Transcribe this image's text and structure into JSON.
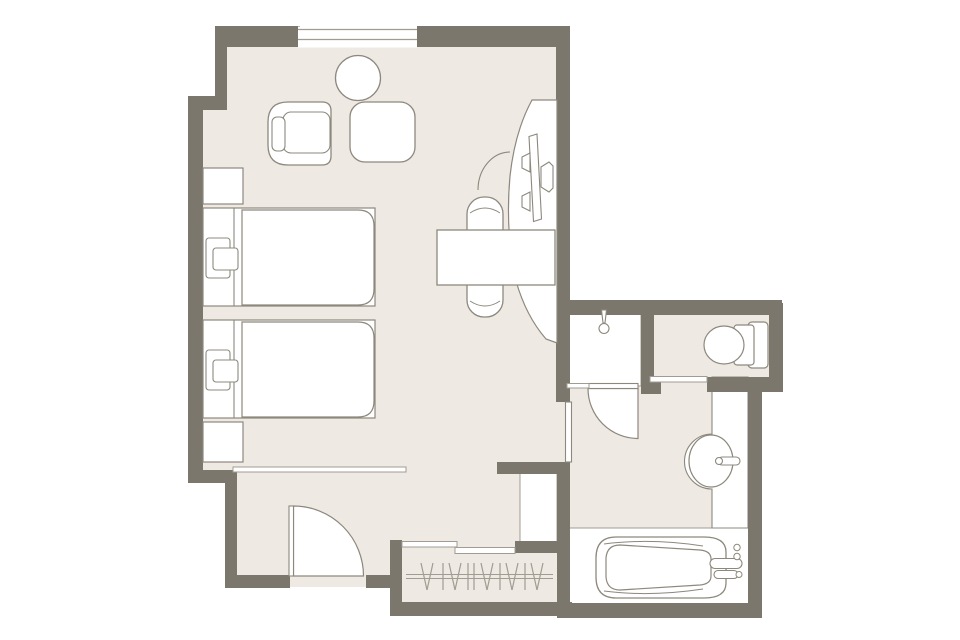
{
  "canvas": {
    "width": 960,
    "height": 640,
    "background": "#ffffff"
  },
  "palette": {
    "wall": "#7b776c",
    "floor": "#efe9e3",
    "white": "#ffffff",
    "stroke": "#8d887d",
    "thin": "#a19c91"
  },
  "plan": {
    "layer_order": [
      "floors",
      "white_areas",
      "walls",
      "window",
      "doors_markers",
      "fixtures",
      "furniture",
      "closet_lines"
    ],
    "floors": [
      {
        "n": "floor-upper-bedroom",
        "t": "rect",
        "x": 218,
        "y": 30,
        "w": 345,
        "h": 80,
        "f": "floor"
      },
      {
        "n": "floor-bedroom",
        "t": "rect",
        "x": 200,
        "y": 100,
        "w": 362,
        "h": 370,
        "f": "floor"
      },
      {
        "n": "floor-entry-corridor",
        "t": "rect",
        "x": 230,
        "y": 464,
        "w": 332,
        "h": 123,
        "f": "floor"
      },
      {
        "n": "floor-closet",
        "t": "rect",
        "x": 396,
        "y": 520,
        "w": 168,
        "h": 88,
        "f": "floor"
      },
      {
        "n": "floor-bathroom",
        "t": "rect",
        "x": 562,
        "y": 308,
        "w": 194,
        "h": 302,
        "f": "floor"
      },
      {
        "n": "floor-toilet-room",
        "t": "rect",
        "x": 648,
        "y": 308,
        "w": 128,
        "h": 77,
        "f": "floor"
      }
    ],
    "white_areas": [
      {
        "n": "shower-tray",
        "t": "rect",
        "x": 566,
        "y": 310,
        "w": 75,
        "h": 76,
        "f": "white",
        "s": "thin",
        "sw": 1
      },
      {
        "n": "bathtub-room-floor",
        "t": "rect",
        "x": 562,
        "y": 528,
        "w": 194,
        "h": 82,
        "f": "white",
        "s": "thin",
        "sw": 1
      },
      {
        "n": "service-void",
        "t": "rect",
        "x": 520,
        "y": 472,
        "w": 37,
        "h": 71,
        "f": "white",
        "s": "thin",
        "sw": 1
      },
      {
        "n": "vanity-counter",
        "t": "path",
        "d": "M712,377 L712,434 A27.5,27.5 0 0 0 712,489 L712,528 L748,528 L748,377 Z",
        "f": "white",
        "s": "stroke",
        "sw": 1.1
      }
    ],
    "walls": [
      {
        "n": "wall-top-left",
        "t": "rect",
        "x": 215,
        "y": 26,
        "w": 85,
        "h": 21,
        "f": "wall"
      },
      {
        "n": "wall-top-right",
        "t": "rect",
        "x": 417,
        "y": 26,
        "w": 153,
        "h": 21,
        "f": "wall"
      },
      {
        "n": "wall-upper-left",
        "t": "rect",
        "x": 215,
        "y": 26,
        "w": 12,
        "h": 76,
        "f": "wall"
      },
      {
        "n": "wall-left-step",
        "t": "rect",
        "x": 188,
        "y": 96,
        "w": 39,
        "h": 14,
        "f": "wall"
      },
      {
        "n": "wall-left",
        "t": "rect",
        "x": 188,
        "y": 96,
        "w": 15,
        "h": 387,
        "f": "wall"
      },
      {
        "n": "wall-entry-step",
        "t": "rect",
        "x": 188,
        "y": 470,
        "w": 49,
        "h": 13,
        "f": "wall"
      },
      {
        "n": "wall-entry-left",
        "t": "rect",
        "x": 225,
        "y": 470,
        "w": 12,
        "h": 118,
        "f": "wall"
      },
      {
        "n": "wall-entry-bottom-a",
        "t": "rect",
        "x": 225,
        "y": 575,
        "w": 65,
        "h": 13,
        "f": "wall"
      },
      {
        "n": "wall-entry-bottom-b",
        "t": "rect",
        "x": 366,
        "y": 575,
        "w": 36,
        "h": 13,
        "f": "wall"
      },
      {
        "n": "wall-closet-left",
        "t": "rect",
        "x": 390,
        "y": 540,
        "w": 12,
        "h": 76,
        "f": "wall"
      },
      {
        "n": "wall-closet-bottom",
        "t": "rect",
        "x": 390,
        "y": 602,
        "w": 182,
        "h": 14,
        "f": "wall"
      },
      {
        "n": "wall-closet-top",
        "t": "rect",
        "x": 515,
        "y": 541,
        "w": 55,
        "h": 12,
        "f": "wall"
      },
      {
        "n": "wall-closet-bath-divider",
        "t": "rect",
        "x": 557,
        "y": 462,
        "w": 13,
        "h": 156,
        "f": "wall"
      },
      {
        "n": "wall-bedroom-south-stub",
        "t": "rect",
        "x": 497,
        "y": 462,
        "w": 73,
        "h": 12,
        "f": "wall"
      },
      {
        "n": "wall-bedroom-right",
        "t": "rect",
        "x": 556,
        "y": 26,
        "w": 14,
        "h": 376,
        "f": "wall"
      },
      {
        "n": "wall-bathroom-top",
        "t": "rect",
        "x": 556,
        "y": 300,
        "w": 226,
        "h": 15,
        "f": "wall"
      },
      {
        "n": "wall-shower-right",
        "t": "rect",
        "x": 641,
        "y": 300,
        "w": 13,
        "h": 90,
        "f": "wall"
      },
      {
        "n": "wall-shower-corner-stub",
        "t": "rect",
        "x": 641,
        "y": 382,
        "w": 20,
        "h": 12,
        "f": "wall"
      },
      {
        "n": "wall-toilet-right",
        "t": "rect",
        "x": 769,
        "y": 303,
        "w": 14,
        "h": 89,
        "f": "wall"
      },
      {
        "n": "wall-toilet-bottom",
        "t": "rect",
        "x": 707,
        "y": 377,
        "w": 76,
        "h": 15,
        "f": "wall"
      },
      {
        "n": "wall-bathroom-right",
        "t": "rect",
        "x": 748,
        "y": 377,
        "w": 14,
        "h": 241,
        "f": "wall"
      },
      {
        "n": "wall-bathroom-bottom",
        "t": "rect",
        "x": 557,
        "y": 603,
        "w": 205,
        "h": 15,
        "f": "wall"
      }
    ],
    "window": [
      {
        "n": "window-opening",
        "t": "rect",
        "x": 298,
        "y": 26.5,
        "w": 119,
        "h": 21,
        "f": "white"
      },
      {
        "n": "window-frame-line-1",
        "t": "line",
        "x1": 298,
        "y1": 29.5,
        "x2": 417,
        "y2": 29.5,
        "s": "thin",
        "sw": 1.2
      },
      {
        "n": "window-frame-line-2",
        "t": "line",
        "x1": 298,
        "y1": 39.5,
        "x2": 417,
        "y2": 39.5,
        "s": "thin",
        "sw": 1.2
      }
    ],
    "doors_markers": [
      {
        "n": "entry-door-swing",
        "t": "path",
        "d": "M293.5,506 A70,70 0 0 1 363.5,576 L293.5,576 Z",
        "f": "white",
        "s": "stroke",
        "sw": 1.2
      },
      {
        "n": "entry-door-leaf",
        "t": "rect",
        "x": 289,
        "y": 506,
        "w": 4.5,
        "h": 70,
        "f": "white",
        "s": "stroke",
        "sw": 1.1
      },
      {
        "n": "bathroom-door-swing",
        "t": "path",
        "d": "M588,388.5 A50,50 0 0 0 638,438.5 L638,388.5 Z",
        "f": "white",
        "s": "stroke",
        "sw": 1.2
      },
      {
        "n": "bathroom-door-leaf",
        "t": "rect",
        "x": 588,
        "y": 383.5,
        "w": 50,
        "h": 5,
        "f": "white",
        "s": "stroke",
        "sw": 1.1
      },
      {
        "n": "bathroom-entry-panel",
        "t": "rect",
        "x": 565.5,
        "y": 402,
        "w": 6,
        "h": 60,
        "f": "white",
        "s": "stroke",
        "sw": 1.1
      },
      {
        "n": "carpet-edge-strip",
        "t": "rect",
        "x": 233,
        "y": 467,
        "w": 173,
        "h": 5,
        "f": "white",
        "s": "thin",
        "sw": 1
      },
      {
        "n": "closet-slider-panel-a",
        "t": "rect",
        "x": 402,
        "y": 541.5,
        "w": 55,
        "h": 5.5,
        "f": "white",
        "s": "thin",
        "sw": 1
      },
      {
        "n": "closet-slider-panel-b",
        "t": "rect",
        "x": 455,
        "y": 547.5,
        "w": 60,
        "h": 6,
        "f": "white",
        "s": "thin",
        "sw": 1
      },
      {
        "n": "toilet-door-track",
        "t": "rect",
        "x": 650,
        "y": 376.5,
        "w": 57,
        "h": 5.5,
        "f": "white",
        "s": "thin",
        "sw": 1
      },
      {
        "n": "shower-glass-panel",
        "t": "rect",
        "x": 567,
        "y": 383.5,
        "w": 22,
        "h": 4.5,
        "f": "white",
        "s": "thin",
        "sw": 1
      }
    ],
    "fixtures": [
      {
        "n": "shower-head-arm",
        "t": "polygon",
        "pts": "601.5,310 606.5,310 605,323 603,323",
        "f": "white",
        "s": "stroke",
        "sw": 1.1
      },
      {
        "n": "shower-head",
        "t": "circle",
        "cx": 604,
        "cy": 328.5,
        "r": 5,
        "f": "white",
        "s": "stroke",
        "sw": 1.1
      },
      {
        "n": "toilet-tank",
        "t": "rect",
        "x": 748,
        "y": 322,
        "w": 20,
        "h": 46,
        "rx": 4,
        "f": "white",
        "s": "stroke",
        "sw": 1.2
      },
      {
        "n": "toilet-seat-bracket",
        "t": "rect",
        "x": 734,
        "y": 325,
        "w": 20,
        "h": 40,
        "rx": 3,
        "f": "white",
        "s": "stroke",
        "sw": 1.2
      },
      {
        "n": "toilet-bowl",
        "t": "ellipse",
        "cx": 724,
        "cy": 345,
        "rx": 20,
        "ry": 19,
        "f": "white",
        "s": "stroke",
        "sw": 1.2
      },
      {
        "n": "sink-basin",
        "t": "ellipse",
        "cx": 711,
        "cy": 461,
        "rx": 22,
        "ry": 26,
        "f": "white",
        "s": "stroke",
        "sw": 1.2
      },
      {
        "n": "sink-faucet",
        "t": "rect",
        "x": 718,
        "y": 457,
        "w": 22,
        "h": 8,
        "rx": 4,
        "f": "white",
        "s": "stroke",
        "sw": 1.1
      },
      {
        "n": "sink-faucet-base",
        "t": "circle",
        "cx": 719,
        "cy": 461,
        "r": 3.5,
        "f": "white",
        "s": "stroke",
        "sw": 1.1
      },
      {
        "n": "bathtub-outer",
        "t": "path",
        "d": "M616,537 L704,537 Q726,537 726,552 L726,583 Q726,598 704,598 L616,598 Q596,598 596,577 L596,558 Q596,537 616,537 Z",
        "f": "white",
        "s": "stroke",
        "sw": 1.3
      },
      {
        "n": "bathtub-rim-top",
        "t": "path",
        "d": "M604,544 Q650,538 703,546",
        "s": "stroke",
        "sw": 1
      },
      {
        "n": "bathtub-rim-bottom",
        "t": "path",
        "d": "M604,591 Q650,597 703,589",
        "s": "stroke",
        "sw": 1
      },
      {
        "n": "bathtub-basin",
        "t": "path",
        "d": "M620,545 Q607,545 606,558 L606,577 Q607,590 620,590 L700,585 Q711,584 711,576 L711,559 Q711,551 700,550 Z",
        "f": "white",
        "s": "stroke",
        "sw": 1.2
      },
      {
        "n": "bathtub-handle-1",
        "t": "rect",
        "x": 710,
        "y": 558.5,
        "w": 32,
        "h": 10,
        "rx": 5,
        "f": "white",
        "s": "stroke",
        "sw": 1.1
      },
      {
        "n": "bathtub-handle-2",
        "t": "rect",
        "x": 714,
        "y": 570.5,
        "w": 24,
        "h": 8,
        "rx": 4,
        "f": "white",
        "s": "stroke",
        "sw": 1.1
      },
      {
        "n": "bathtub-knob-1",
        "t": "circle",
        "cx": 737,
        "cy": 547.5,
        "r": 3.2,
        "f": "white",
        "s": "stroke",
        "sw": 1
      },
      {
        "n": "bathtub-knob-2",
        "t": "circle",
        "cx": 737,
        "cy": 556.5,
        "r": 3.2,
        "f": "white",
        "s": "stroke",
        "sw": 1
      },
      {
        "n": "bathtub-knob-3",
        "t": "circle",
        "cx": 739,
        "cy": 574.5,
        "r": 3,
        "f": "white",
        "s": "stroke",
        "sw": 1
      }
    ],
    "furniture": [
      {
        "n": "round-table",
        "t": "circle",
        "cx": 358,
        "cy": 78,
        "r": 22.5,
        "f": "white",
        "s": "stroke",
        "sw": 1.3
      },
      {
        "n": "lounge-chair-outer",
        "t": "path",
        "d": "M288,102 L322,102 Q331,102 331,111 L331,156 Q331,165 322,165 L288,165 Q268,165 268,145 L268,122 Q268,102 288,102 Z",
        "f": "white",
        "s": "stroke",
        "sw": 1.3
      },
      {
        "n": "lounge-chair-seat",
        "t": "rect",
        "x": 283,
        "y": 112,
        "w": 47,
        "h": 41,
        "rx": 8,
        "f": "white",
        "s": "stroke",
        "sw": 1.1
      },
      {
        "n": "lounge-chair-arm",
        "t": "rect",
        "x": 272,
        "y": 117,
        "w": 13,
        "h": 34,
        "rx": 5,
        "f": "white",
        "s": "stroke",
        "sw": 1.1
      },
      {
        "n": "side-table",
        "t": "rect",
        "x": 350,
        "y": 102,
        "w": 65,
        "h": 60,
        "rx": 15,
        "f": "white",
        "s": "stroke",
        "sw": 1.3
      },
      {
        "n": "tv-console",
        "t": "path",
        "d": "M557,100 L532,100 Q515,131 510,176 Q505,231 516,281 Q526,316 546,339 L557,343 Z",
        "f": "white",
        "s": "stroke",
        "sw": 1.2
      },
      {
        "n": "console-door-arc",
        "t": "path",
        "d": "M478,190 A32,38 0 0 1 510,152",
        "s": "stroke",
        "sw": 1.1
      },
      {
        "n": "tv-screen",
        "t": "polygon",
        "pts": "529,136.5 537,134 541.5,219 533.5,221.5",
        "f": "white",
        "s": "stroke",
        "sw": 1.1
      },
      {
        "n": "tv-bracket-a",
        "t": "polygon",
        "pts": "522,157 530,153 530,172 522,168",
        "f": "white",
        "s": "stroke",
        "sw": 1.1
      },
      {
        "n": "tv-bracket-b",
        "t": "polygon",
        "pts": "522,196 530,192 530,211 522,207",
        "f": "white",
        "s": "stroke",
        "sw": 1.1
      },
      {
        "n": "tv-mount-hub",
        "t": "polygon",
        "pts": "541,167 549,162 553,166 553,188 549,192 541,187",
        "f": "white",
        "s": "stroke",
        "sw": 1.1
      },
      {
        "n": "desk-chair",
        "t": "rect",
        "x": 467,
        "y": 197,
        "w": 36,
        "h": 120,
        "rx": 17,
        "f": "white",
        "s": "stroke",
        "sw": 1.3
      },
      {
        "n": "desk-chair-line-top",
        "t": "path",
        "d": "M470,213 Q485,203 500,213",
        "s": "stroke",
        "sw": 1
      },
      {
        "n": "desk-chair-line-bottom",
        "t": "path",
        "d": "M470,301 Q485,311 500,301",
        "s": "stroke",
        "sw": 1
      },
      {
        "n": "desk",
        "t": "rect",
        "x": 437,
        "y": 230,
        "w": 118,
        "h": 55,
        "f": "white",
        "s": "stroke",
        "sw": 1.3
      },
      {
        "n": "nightstand-1",
        "t": "rect",
        "x": 203,
        "y": 168,
        "w": 40,
        "h": 36,
        "f": "white",
        "s": "stroke",
        "sw": 1.2
      },
      {
        "n": "bed-1-base",
        "t": "rect",
        "x": 203,
        "y": 208,
        "w": 172,
        "h": 98,
        "f": "white",
        "s": "stroke",
        "sw": 1.2
      },
      {
        "n": "bed-1-headboard-line",
        "t": "line",
        "x1": 234,
        "y1": 208,
        "x2": 234,
        "y2": 306,
        "s": "stroke",
        "sw": 1.1
      },
      {
        "n": "bed-1-mattress",
        "t": "path",
        "d": "M242,210 L358,210 Q374,210 374,226 L374,289 Q374,305 358,305 L242,305 Z",
        "f": "white",
        "s": "stroke",
        "sw": 1.2
      },
      {
        "n": "bed-1-lamp-outer",
        "t": "rect",
        "x": 206,
        "y": 238,
        "w": 24,
        "h": 40,
        "rx": 3,
        "f": "white",
        "s": "stroke",
        "sw": 1.1
      },
      {
        "n": "bed-1-lamp-inner",
        "t": "rect",
        "x": 213,
        "y": 248,
        "w": 25,
        "h": 22,
        "rx": 3,
        "f": "white",
        "s": "stroke",
        "sw": 1.1
      },
      {
        "n": "bed-2-base",
        "t": "rect",
        "x": 203,
        "y": 320,
        "w": 172,
        "h": 98,
        "f": "white",
        "s": "stroke",
        "sw": 1.2
      },
      {
        "n": "bed-2-headboard-line",
        "t": "line",
        "x1": 234,
        "y1": 320,
        "x2": 234,
        "y2": 418,
        "s": "stroke",
        "sw": 1.1
      },
      {
        "n": "bed-2-mattress",
        "t": "path",
        "d": "M242,322 L358,322 Q374,322 374,338 L374,401 Q374,417 358,417 L242,417 Z",
        "f": "white",
        "s": "stroke",
        "sw": 1.2
      },
      {
        "n": "bed-2-lamp-outer",
        "t": "rect",
        "x": 206,
        "y": 350,
        "w": 24,
        "h": 40,
        "rx": 3,
        "f": "white",
        "s": "stroke",
        "sw": 1.1
      },
      {
        "n": "bed-2-lamp-inner",
        "t": "rect",
        "x": 213,
        "y": 360,
        "w": 25,
        "h": 22,
        "rx": 3,
        "f": "white",
        "s": "stroke",
        "sw": 1.1
      },
      {
        "n": "nightstand-2",
        "t": "rect",
        "x": 203,
        "y": 422,
        "w": 40,
        "h": 40,
        "f": "white",
        "s": "stroke",
        "sw": 1.2
      }
    ],
    "closet_lines": [
      {
        "n": "closet-rail-top",
        "t": "line",
        "x1": 406,
        "y1": 574.5,
        "x2": 553,
        "y2": 574.5,
        "s": "thin",
        "sw": 1.1
      },
      {
        "n": "closet-rail-bottom",
        "t": "line",
        "x1": 406,
        "y1": 578.5,
        "x2": 553,
        "y2": 578.5,
        "s": "thin",
        "sw": 1.1
      }
    ],
    "hanger_lines": [
      [
        421,
        563,
        427,
        590
      ],
      [
        433,
        563,
        427,
        590
      ],
      [
        443,
        563,
        443,
        590
      ],
      [
        449,
        563,
        455,
        590
      ],
      [
        461,
        563,
        455,
        590
      ],
      [
        468,
        563,
        468,
        590
      ],
      [
        474,
        563,
        474,
        590
      ],
      [
        481,
        563,
        487,
        590
      ],
      [
        493,
        563,
        487,
        590
      ],
      [
        500,
        563,
        500,
        590
      ],
      [
        506,
        563,
        512,
        590
      ],
      [
        518,
        563,
        512,
        590
      ],
      [
        525,
        563,
        525,
        590
      ],
      [
        531,
        563,
        537,
        590
      ],
      [
        543,
        563,
        537,
        590
      ]
    ]
  }
}
